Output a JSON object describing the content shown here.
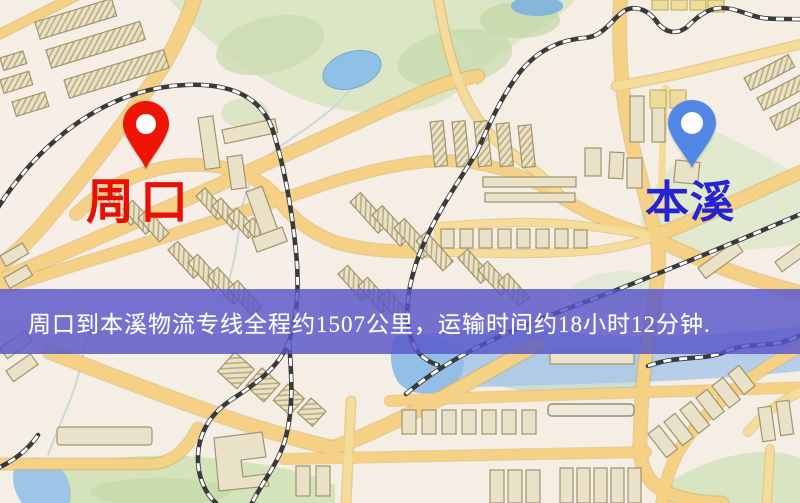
{
  "page": {
    "width": 800,
    "height": 503,
    "kind": "logistics-route-map"
  },
  "map": {
    "markers": [
      {
        "id": "origin",
        "label": "周口",
        "label_color": "#e90f05",
        "pin_color": "#ee1506"
      },
      {
        "id": "destination",
        "label": "本溪",
        "label_color": "#2823d2",
        "pin_color": "#5287e6"
      }
    ]
  },
  "banner": {
    "text": "周口到本溪物流专线全程约1507公里，运输时间约18小时12分钟.",
    "origin": "周口",
    "destination": "本溪",
    "distance": "约1507公里",
    "duration": "约18小时12分钟",
    "background_color": "#5855c9",
    "text_color": "#ffffff"
  }
}
